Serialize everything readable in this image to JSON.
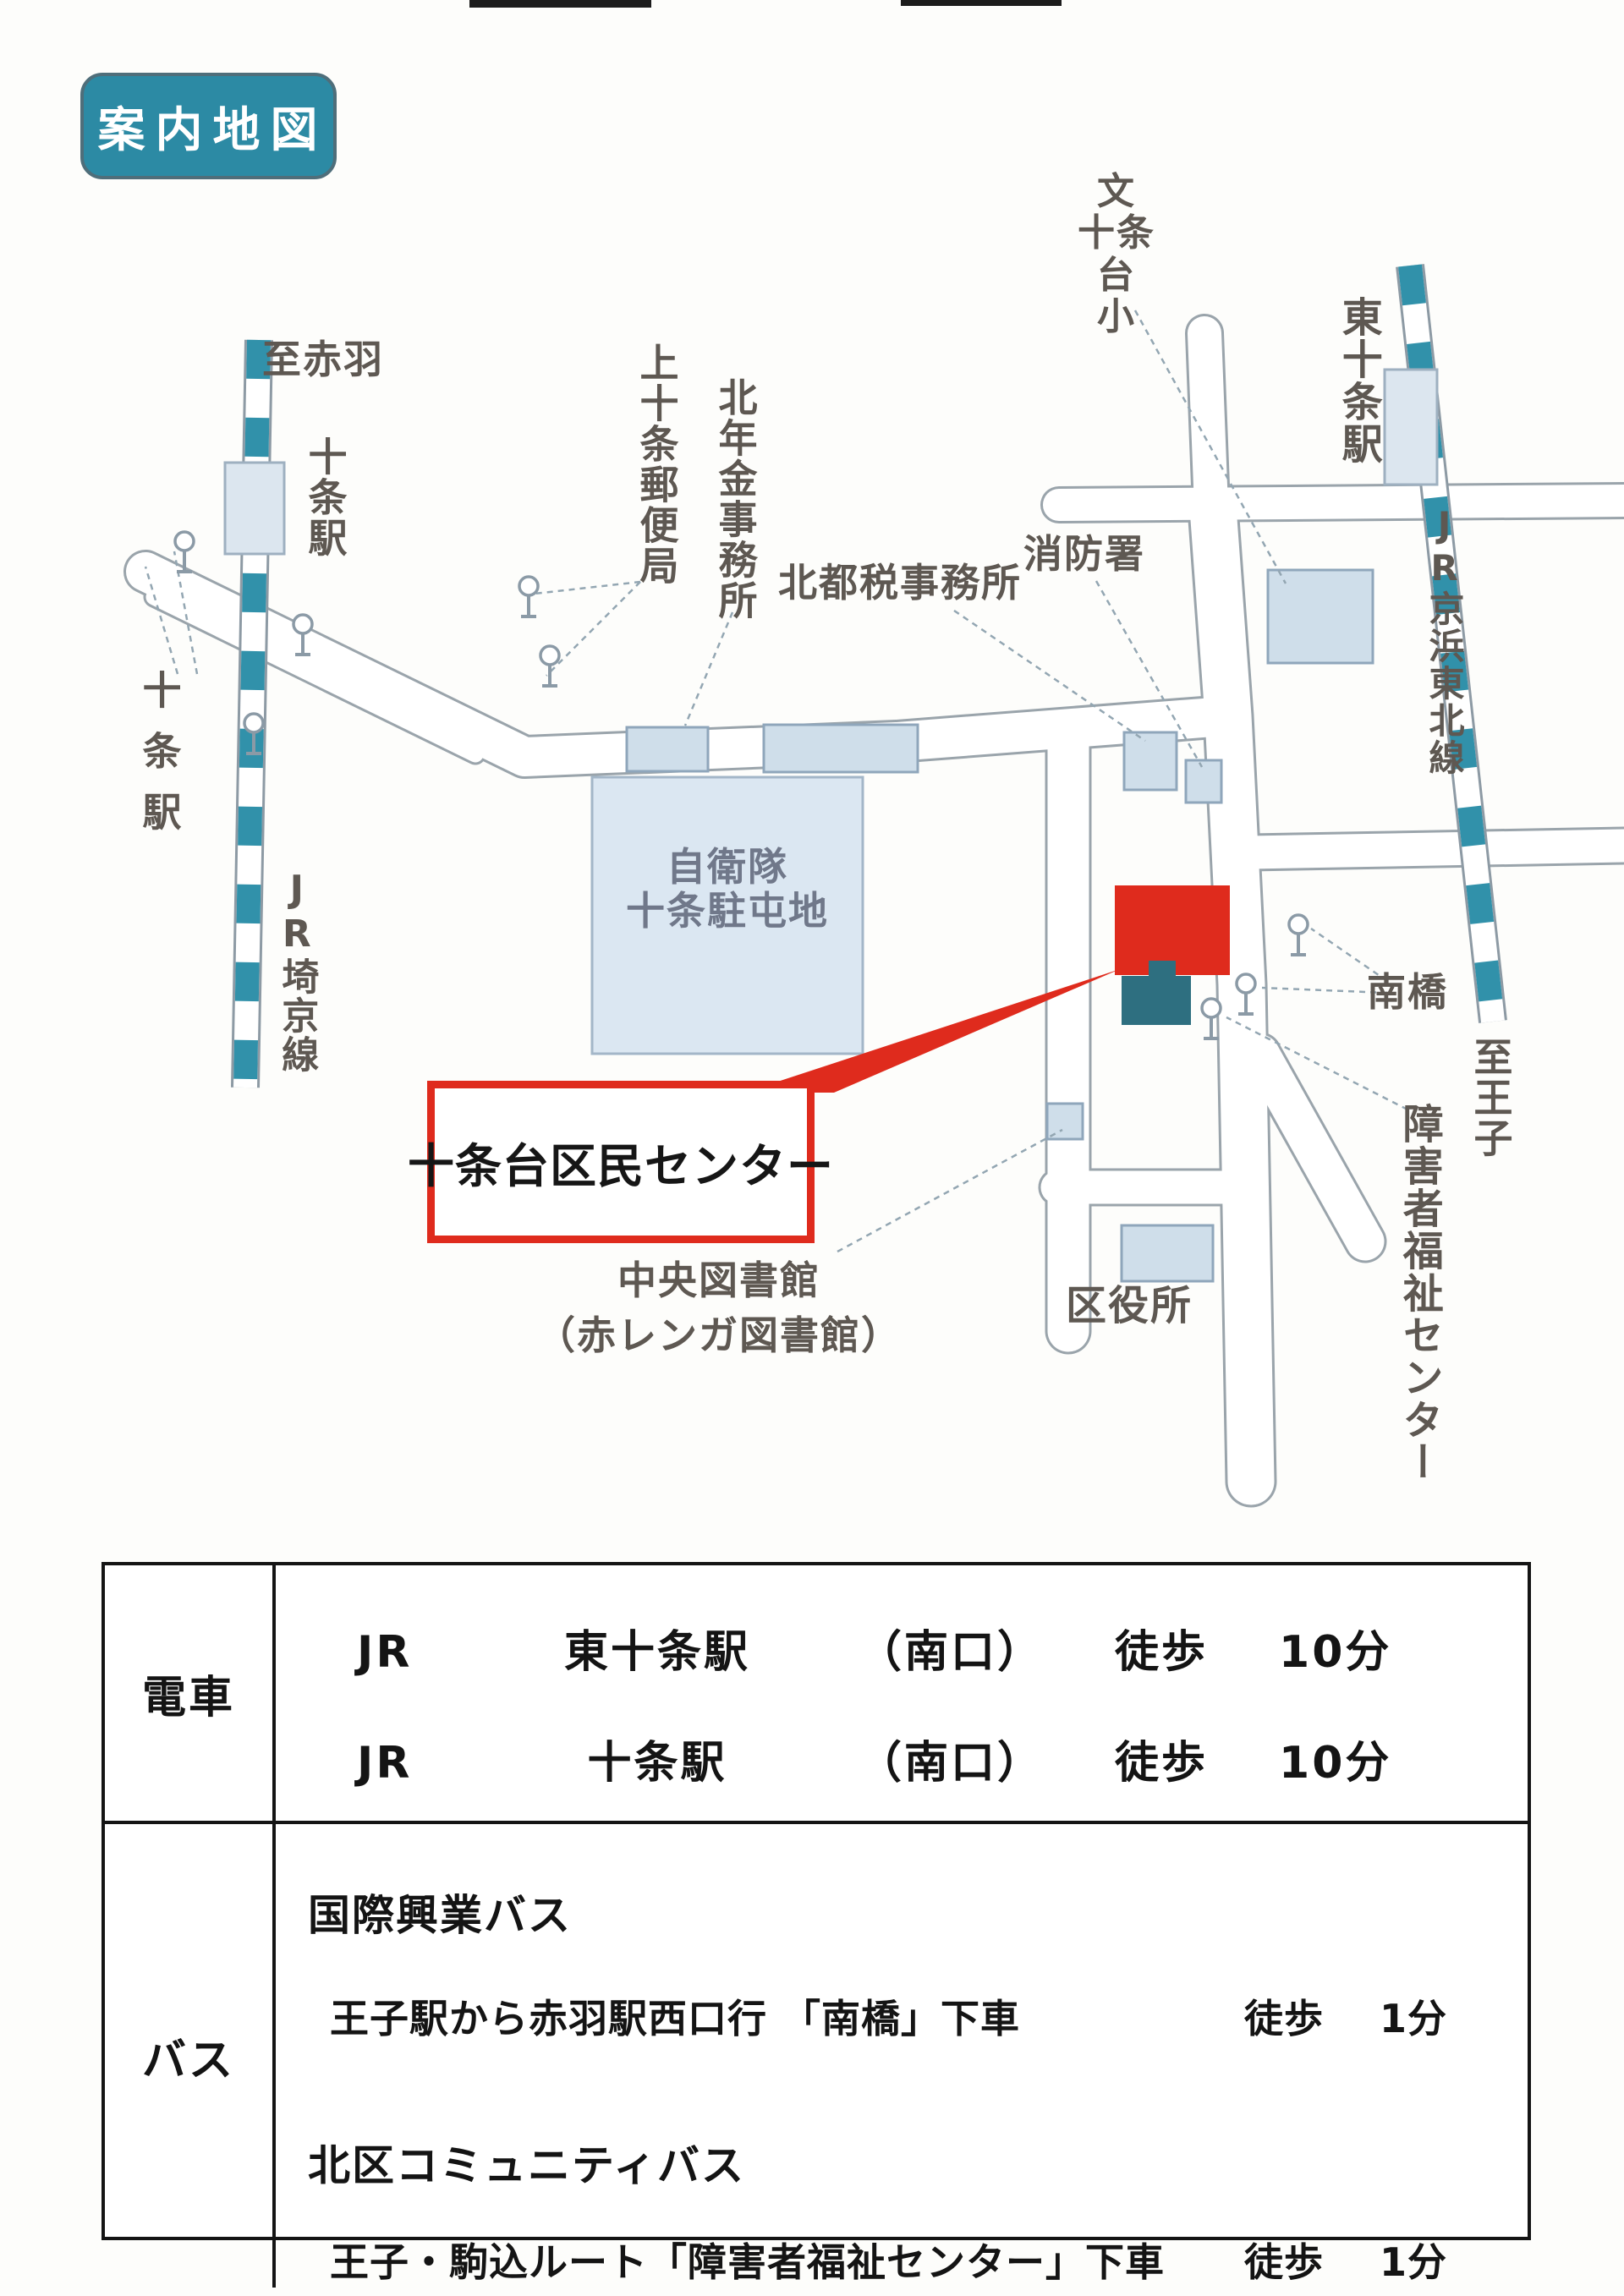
{
  "badge": {
    "label": "案内地図"
  },
  "map": {
    "labels": {
      "to_akabane": "至赤羽",
      "jujo_station_east": "十条駅",
      "jujo_station_west": "十条駅",
      "jr_saikyo_line": "JR埼京線",
      "kami_jujo_post_office": "上十条郵便局",
      "kita_pension_office": "北年金事務所",
      "kita_tax_office": "北都税事務所",
      "fire_station": "消防署",
      "school_line1": "文",
      "school_line2": "十条台",
      "school_line3": "小",
      "higashi_jujo_station": "東十条駅",
      "jr_keihin_tohoku_line": "JR京浜東北線",
      "jsdf_line1": "自衛隊",
      "jsdf_line2": "十条駐屯地",
      "minamibashi": "南橋",
      "to_oji": "至王子",
      "disabled_welfare_center": "障害者福祉センター",
      "central_library_line1": "中央図書館",
      "central_library_line2": "（赤レンガ図書館）",
      "ward_office": "区役所"
    },
    "callout": {
      "label": "十条台区民センター"
    }
  },
  "access_table": {
    "train": {
      "header": "電車",
      "lines": [
        {
          "company": "JR",
          "station": "東十条駅",
          "exit": "（南口）",
          "mode": "徒歩",
          "time": "10分"
        },
        {
          "company": "JR",
          "station": "十条駅",
          "exit": "（南口）",
          "mode": "徒歩",
          "time": "10分"
        }
      ]
    },
    "bus": {
      "header": "バス",
      "services": [
        {
          "operator": "国際興業バス",
          "route": "王子駅から赤羽駅西口行 「南橋」下車",
          "mode": "徒歩",
          "time": "1分"
        },
        {
          "operator": "北区コミュニティバス",
          "route": "王子・駒込ルート「障害者福祉センター」下車",
          "mode": "徒歩",
          "time": "1分"
        }
      ]
    }
  },
  "colors": {
    "badge_teal": "#2c8aa4",
    "rail_teal": "#3191aa",
    "building_fill": "#cfdeea",
    "building_stroke": "#8fa6bb",
    "highlight_red": "#df2b1d",
    "welfare_teal": "#2e6f80",
    "road_stroke": "#9aa4ab",
    "label_gray": "#5e5852"
  }
}
